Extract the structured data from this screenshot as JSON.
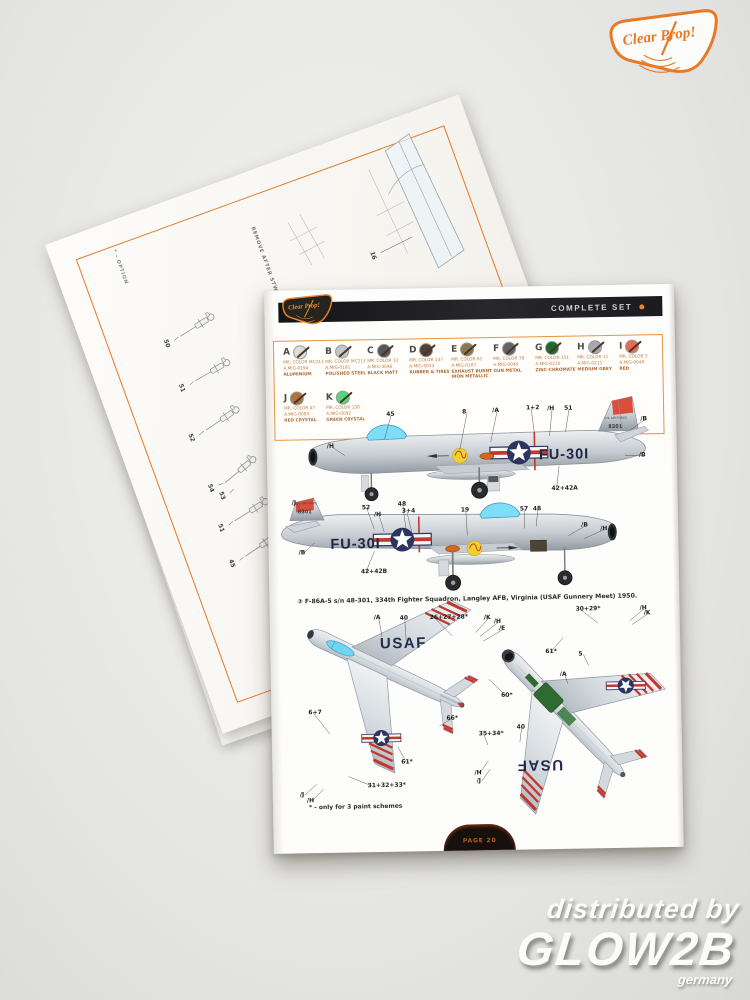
{
  "scene": {
    "brand_badge_text": "Clear Prop!",
    "watermark": {
      "line1": "distributed by",
      "line2": "GLOW2B",
      "line3": "germany"
    }
  },
  "back_page": {
    "option_note": "* - OPTION",
    "remove_note": "REMOVE AFTER STW",
    "callouts": [
      {
        "label": "16",
        "x": 308,
        "y": 118,
        "tx": 348,
        "ty": 118
      },
      {
        "label": "50",
        "x": 84,
        "y": 130,
        "tx": 94,
        "ty": 132
      },
      {
        "label": "51",
        "x": 83,
        "y": 177,
        "tx": 93,
        "ty": 179
      },
      {
        "label": "52",
        "x": 75,
        "y": 227,
        "tx": 86,
        "ty": 229
      },
      {
        "label": "54",
        "x": 76,
        "y": 281,
        "tx": 86,
        "ty": 285
      },
      {
        "label": "53",
        "x": 84,
        "y": 292,
        "tx": 94,
        "ty": 294
      },
      {
        "label": "51",
        "x": 72,
        "y": 322,
        "tx": 82,
        "ty": 324
      },
      {
        "label": "45",
        "x": 70,
        "y": 359,
        "tx": 80,
        "ty": 361
      }
    ]
  },
  "page": {
    "header": {
      "title": "COMPLETE SET",
      "badge": "Clear Prop!"
    },
    "palette": [
      {
        "letter": "A",
        "code1": "MR. COLOR MC211",
        "code2": "A.MIG-0194",
        "name": "ALUMINIUM",
        "color": "#dcdcda",
        "x": 18,
        "y": 55
      },
      {
        "letter": "B",
        "code1": "MR. COLOR MC213",
        "code2": "A.MIG-0191",
        "name": "POLISHED STEEL",
        "color": "#c2c6c9",
        "x": 60,
        "y": 55
      },
      {
        "letter": "C",
        "code1": "MR. COLOR 33",
        "code2": "A.MIG-0046",
        "name": "BLACK MATT",
        "color": "#55565c",
        "x": 102,
        "y": 55
      },
      {
        "letter": "D",
        "code1": "MR. COLOR 137",
        "code2": "A.MIG-0033",
        "name": "RUBBER & TIRES",
        "color": "#4e4237",
        "x": 144,
        "y": 55
      },
      {
        "letter": "E",
        "code1": "MR. COLOR 61",
        "code2": "A.MIG-0187",
        "name": "EXHAUST BURNT IRON METALLIC",
        "color": "#8a7750",
        "x": 186,
        "y": 55
      },
      {
        "letter": "F",
        "code1": "MR. COLOR 78",
        "code2": "A.MIG-0045",
        "name": "GUN METAL",
        "color": "#63646b",
        "x": 228,
        "y": 55
      },
      {
        "letter": "G",
        "code1": "MR. COLOR 351",
        "code2": "A.MIG-0220",
        "name": "ZINC-CHROMATE",
        "color": "#1e6b2d",
        "x": 270,
        "y": 55
      },
      {
        "letter": "H",
        "code1": "MR. COLOR 11",
        "code2": "A.MIG-0211",
        "name": "MEDIUM GREY",
        "color": "#a5aaaf",
        "x": 312,
        "y": 55
      },
      {
        "letter": "I",
        "code1": "MR. COLOR 3",
        "code2": "A.MIG-0049",
        "name": "RED",
        "color": "#e56a57",
        "x": 354,
        "y": 55
      },
      {
        "letter": "J",
        "code1": "MR. COLOR 47",
        "code2": "A.MIG-0093",
        "name": "RED CRYSTAL",
        "color": "#ad7440",
        "x": 18,
        "y": 101
      },
      {
        "letter": "K",
        "code1": "MR. COLOR 138",
        "code2": "A.MIG-0092",
        "name": "GREEN CRYSTAL",
        "color": "#57d57d",
        "x": 60,
        "y": 101
      }
    ],
    "aircraft_text": {
      "buzz_number": "FU-30I",
      "tail_number": "8301",
      "air_force": "U.S. AIR FORCE",
      "usaf": "USAF"
    },
    "caption": "③ F-86A-5 s/n 48-301, 334th Fighter Squadron, Langley AFB, Virginia (USAF Gunnery Meet) 1950.",
    "footnote": "* - only for 3 paint schemes",
    "page_tab": "PAGE 20",
    "profile1_callouts": [
      {
        "label": "45",
        "x": 120,
        "y": 122,
        "tx": 118,
        "ty": 150
      },
      {
        "label": "8",
        "x": 196,
        "y": 121,
        "tx": 193,
        "ty": 162
      },
      {
        "label": "/A",
        "x": 226,
        "y": 120,
        "tx": 224,
        "ty": 155
      },
      {
        "label": "1+2",
        "x": 260,
        "y": 118,
        "tx": 268,
        "ty": 148
      },
      {
        "label": "/H",
        "x": 281,
        "y": 119,
        "tx": 283,
        "ty": 150
      },
      {
        "label": "51",
        "x": 298,
        "y": 119,
        "tx": 299,
        "ty": 146
      },
      {
        "label": "/B",
        "x": 374,
        "y": 131,
        "tx": 363,
        "ty": 146
      },
      {
        "label": "/H",
        "x": 60,
        "y": 153,
        "tx": 78,
        "ty": 166
      },
      {
        "label": "/B",
        "x": 372,
        "y": 167,
        "tx": 358,
        "ty": 171
      },
      {
        "label": "42+42A",
        "x": 284,
        "y": 199,
        "tx": 292,
        "ty": 180
      }
    ],
    "profile2_callouts": [
      {
        "label": "/J",
        "x": 24,
        "y": 209,
        "tx": 34,
        "ty": 222
      },
      {
        "label": "52",
        "x": 94,
        "y": 215,
        "tx": 106,
        "ty": 240
      },
      {
        "label": "/H",
        "x": 106,
        "y": 222,
        "tx": 116,
        "ty": 243
      },
      {
        "label": "48",
        "x": 130,
        "y": 212,
        "tx": 138,
        "ty": 242
      },
      {
        "label": "3+4",
        "x": 134,
        "y": 219,
        "tx": 144,
        "ty": 246
      },
      {
        "label": "19",
        "x": 193,
        "y": 219,
        "tx": 199,
        "ty": 248
      },
      {
        "label": "57",
        "x": 252,
        "y": 219,
        "tx": 256,
        "ty": 242
      },
      {
        "label": "48",
        "x": 265,
        "y": 219,
        "tx": 268,
        "ty": 240
      },
      {
        "label": "/B",
        "x": 313,
        "y": 236,
        "tx": 300,
        "ty": 250
      },
      {
        "label": "/H",
        "x": 332,
        "y": 240,
        "tx": 316,
        "ty": 253
      },
      {
        "label": "/B",
        "x": 30,
        "y": 259,
        "tx": 46,
        "ty": 253
      },
      {
        "label": "42+42B",
        "x": 92,
        "y": 279,
        "tx": 106,
        "ty": 262
      }
    ],
    "plan_callouts": [
      {
        "label": "/A",
        "x": 104,
        "y": 325,
        "tx": 112,
        "ty": 348
      },
      {
        "label": "40",
        "x": 130,
        "y": 326,
        "tx": 136,
        "ty": 352
      },
      {
        "label": "26+27+28*",
        "x": 160,
        "y": 326,
        "tx": 182,
        "ty": 348
      },
      {
        "label": "/K",
        "x": 214,
        "y": 327,
        "tx": 206,
        "ty": 345
      },
      {
        "label": "/H",
        "x": 224,
        "y": 331,
        "tx": 210,
        "ty": 349
      },
      {
        "label": "/E",
        "x": 229,
        "y": 338,
        "tx": 213,
        "ty": 354
      },
      {
        "label": "30+29*",
        "x": 306,
        "y": 320,
        "tx": 328,
        "ty": 338
      },
      {
        "label": "/H",
        "x": 370,
        "y": 320,
        "tx": 360,
        "ty": 336
      },
      {
        "label": "/K",
        "x": 374,
        "y": 325,
        "tx": 362,
        "ty": 340
      },
      {
        "label": "61*",
        "x": 275,
        "y": 362,
        "tx": 293,
        "ty": 352
      },
      {
        "label": "5",
        "x": 308,
        "y": 365,
        "tx": 318,
        "ty": 380
      },
      {
        "label": "/A",
        "x": 289,
        "y": 385,
        "tx": 297,
        "ty": 398
      },
      {
        "label": "6+7",
        "x": 37,
        "y": 419,
        "tx": 58,
        "ty": 444
      },
      {
        "label": "66*",
        "x": 175,
        "y": 427,
        "tx": 168,
        "ty": 438
      },
      {
        "label": "60*",
        "x": 230,
        "y": 405,
        "tx": 218,
        "ty": 392
      },
      {
        "label": "61*",
        "x": 129,
        "y": 470,
        "tx": 126,
        "ty": 458
      },
      {
        "label": "35+34*",
        "x": 207,
        "y": 443,
        "tx": 216,
        "ty": 458
      },
      {
        "label": "40",
        "x": 245,
        "y": 437,
        "tx": 248,
        "ty": 455
      },
      {
        "label": "31+32+33*",
        "x": 95,
        "y": 493,
        "tx": 76,
        "ty": 487
      },
      {
        "label": "/J",
        "x": 27,
        "y": 501,
        "tx": 44,
        "ty": 494
      },
      {
        "label": "/H",
        "x": 34,
        "y": 507,
        "tx": 51,
        "ty": 499
      },
      {
        "label": "/H",
        "x": 202,
        "y": 482,
        "tx": 216,
        "ty": 474
      },
      {
        "label": "/J",
        "x": 204,
        "y": 490,
        "tx": 218,
        "ty": 482
      }
    ]
  }
}
